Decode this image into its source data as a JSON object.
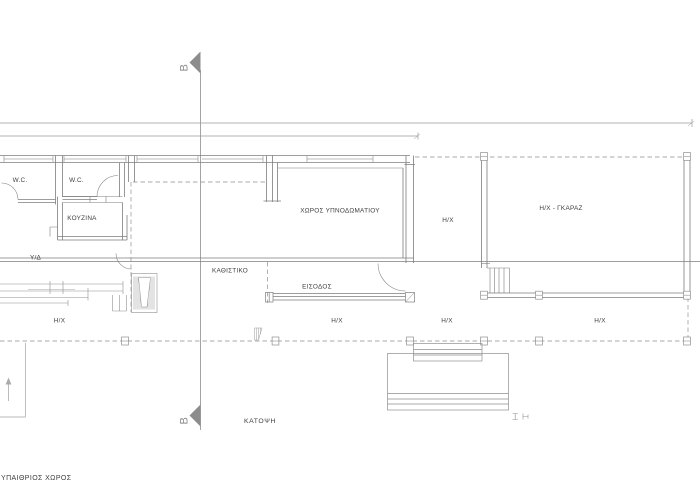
{
  "drawing": {
    "type": "architectural-floor-plan",
    "colors": {
      "line": "#8f8f8f",
      "wall": "#7e7e7e",
      "light_line": "#b8b8b8",
      "text": "#3e3e3e",
      "section_marker": "#8c8c8c",
      "background": "#ffffff"
    },
    "labels": {
      "wc_1": "W.C.",
      "wc_2": "W.C.",
      "kitchen": "ΚΟΥΖΙΝΑ",
      "bedroom": "ΧΩΡΟΣ ΥΠΝΟΔΩΜΑΤΙΟΥ",
      "utility": "Υ/Δ",
      "living_room": "ΚΑΘΙΣΤΙΚΟ",
      "entrance": "ΕΙΣΟΔΟΣ",
      "hx_room": "Η/Χ",
      "garage": "Η/Χ - ΓΚΑΡΑΖ",
      "hx_veranda_left": "Η/Χ",
      "hx_veranda_center": "Η/Χ",
      "hx_veranda_right": "Η/Χ",
      "hx_veranda_far_right": "Η/Χ",
      "plan_title": "ΚΑΤΟΨΗ",
      "outdoor_space": "ΥΠΑΙΘΡΙΟΣ ΧΩΡΟΣ",
      "section_top": "B",
      "section_bottom": "B"
    }
  }
}
